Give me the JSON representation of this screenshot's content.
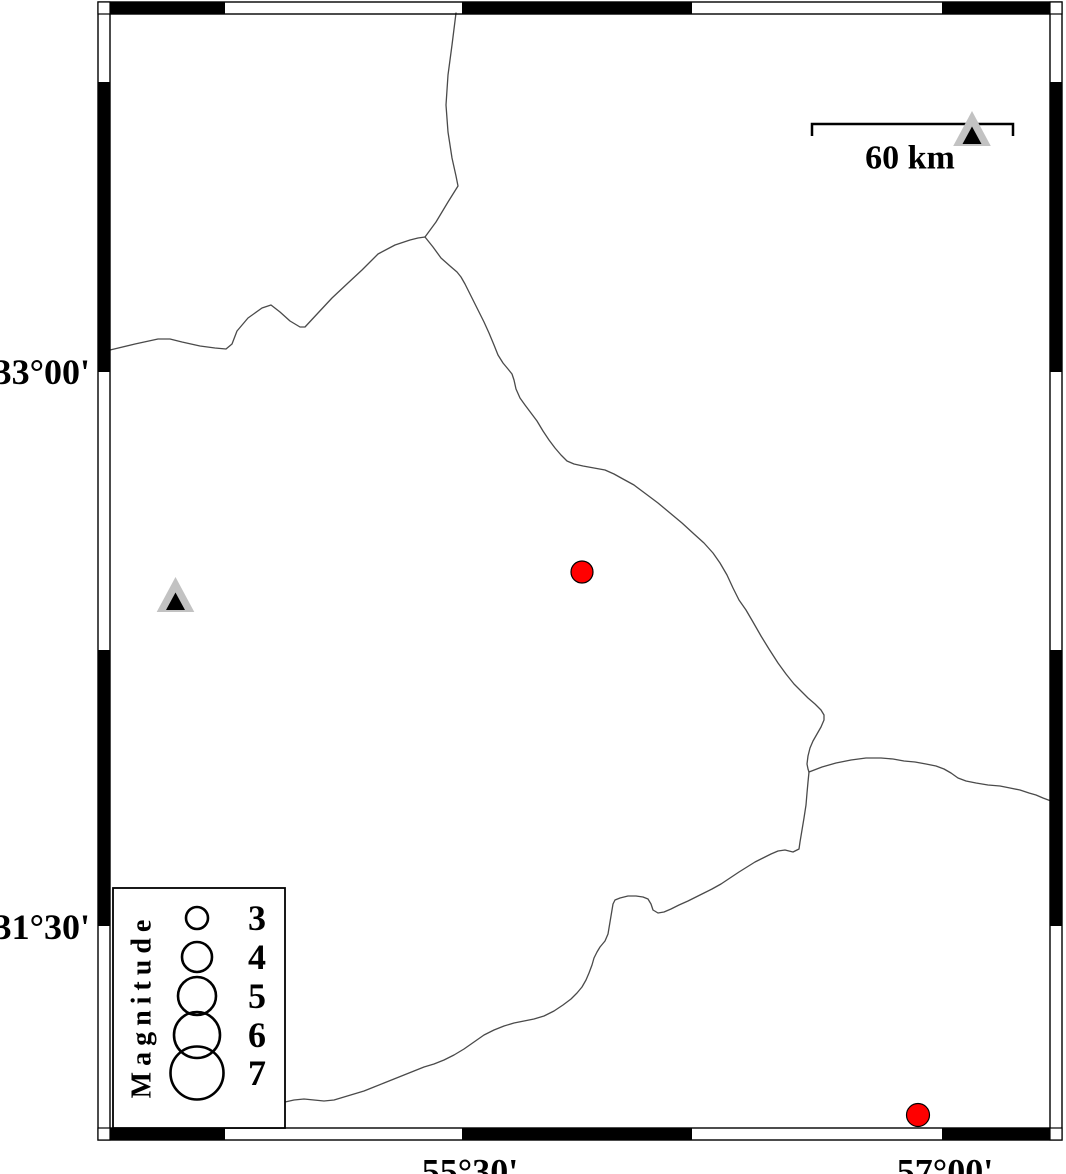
{
  "map": {
    "frame": {
      "lat_ticks": [
        {
          "label": "33°00'",
          "y": 372
        },
        {
          "label": "31°30'",
          "y": 927
        }
      ],
      "lon_ticks": [
        {
          "label": "55°30'",
          "x": 470
        },
        {
          "label": "57°00'",
          "x": 945
        }
      ]
    },
    "scale_bar": {
      "label": "60 km"
    },
    "legend": {
      "title": "Magnitude",
      "entries": [
        {
          "label": "3",
          "y": 918,
          "r": 11
        },
        {
          "label": "4",
          "y": 957,
          "r": 15
        },
        {
          "label": "5",
          "y": 996,
          "r": 19
        },
        {
          "label": "6",
          "y": 1035,
          "r": 23
        },
        {
          "label": "7",
          "y": 1073,
          "r": 26.5
        }
      ]
    },
    "earthquakes": [
      {
        "x": 582,
        "y": 572,
        "r": 11
      },
      {
        "x": 918,
        "y": 1115,
        "r": 11.5
      }
    ],
    "stations": [
      {
        "transform": "translate(972,129)"
      },
      {
        "transform": "translate(175.5,595)"
      }
    ],
    "colors": {
      "earthquake_red": "#ff0000",
      "station_gray": "#c2c2c2",
      "station_core": "#000000",
      "boundary_line": "#4a4a4a",
      "frame": "#000000"
    }
  }
}
